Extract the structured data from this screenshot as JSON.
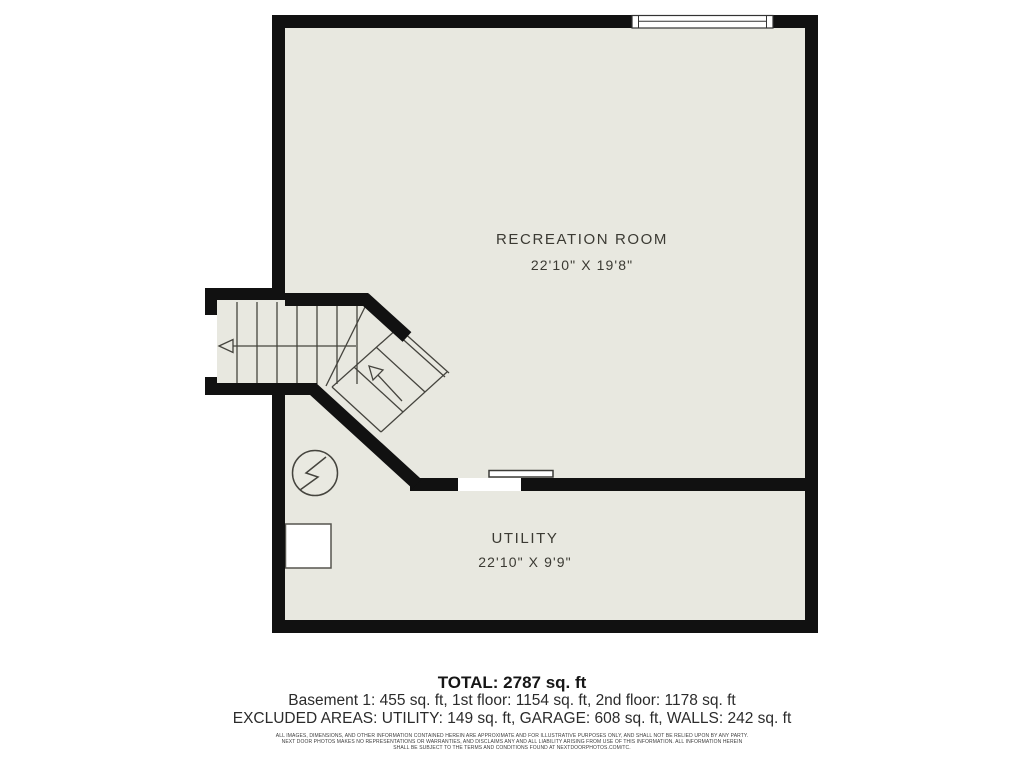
{
  "floor_plan": {
    "title": "Basement floor plan",
    "rooms": [
      {
        "name": "RECREATION ROOM",
        "dimensions": "22'10\" X 19'8\""
      },
      {
        "name": "UTILITY",
        "dimensions": "22'10\" X 9'9\""
      }
    ],
    "symbols": [
      {
        "name": "staircase",
        "note": "straight flight with left up-arrow plus 45-degree winder flight with up-arrow"
      },
      {
        "name": "electrical-panel-icon",
        "note": "circle with lightning zigzag"
      },
      {
        "name": "water-heater-box",
        "note": "white rectangle against left wall"
      },
      {
        "name": "window",
        "note": "top wall window symbol"
      },
      {
        "name": "sliding-door",
        "note": "door leaf over wall opening between rooms"
      }
    ],
    "colors": {
      "floor": "#e8e8e0",
      "wall": "#111111",
      "line": "#45443e",
      "page": "#ffffff"
    }
  },
  "summary": {
    "total": "TOTAL: 2787 sq. ft",
    "floors": "Basement 1: 455 sq. ft, 1st floor: 1154 sq. ft, 2nd floor: 1178 sq. ft",
    "excluded": "EXCLUDED AREAS: UTILITY: 149 sq. ft, GARAGE: 608 sq. ft, WALLS: 242 sq. ft"
  },
  "disclaimer": {
    "line1": "ALL IMAGES, DIMENSIONS, AND OTHER INFORMATION CONTAINED HEREIN ARE APPROXIMATE AND FOR ILLUSTRATIVE PURPOSES ONLY, AND SHALL NOT BE RELIED UPON BY ANY PARTY.",
    "line2": "NEXT DOOR PHOTOS MAKES NO REPRESENTATIONS OR WARRANTIES, AND DISCLAIMS ANY AND ALL LIABILITY ARISING FROM USE OF THIS INFORMATION. ALL INFORMATION HEREIN",
    "line3": "SHALL BE SUBJECT TO THE TERMS AND CONDITIONS FOUND AT NEXTDOORPHOTOS.COM/TC."
  }
}
